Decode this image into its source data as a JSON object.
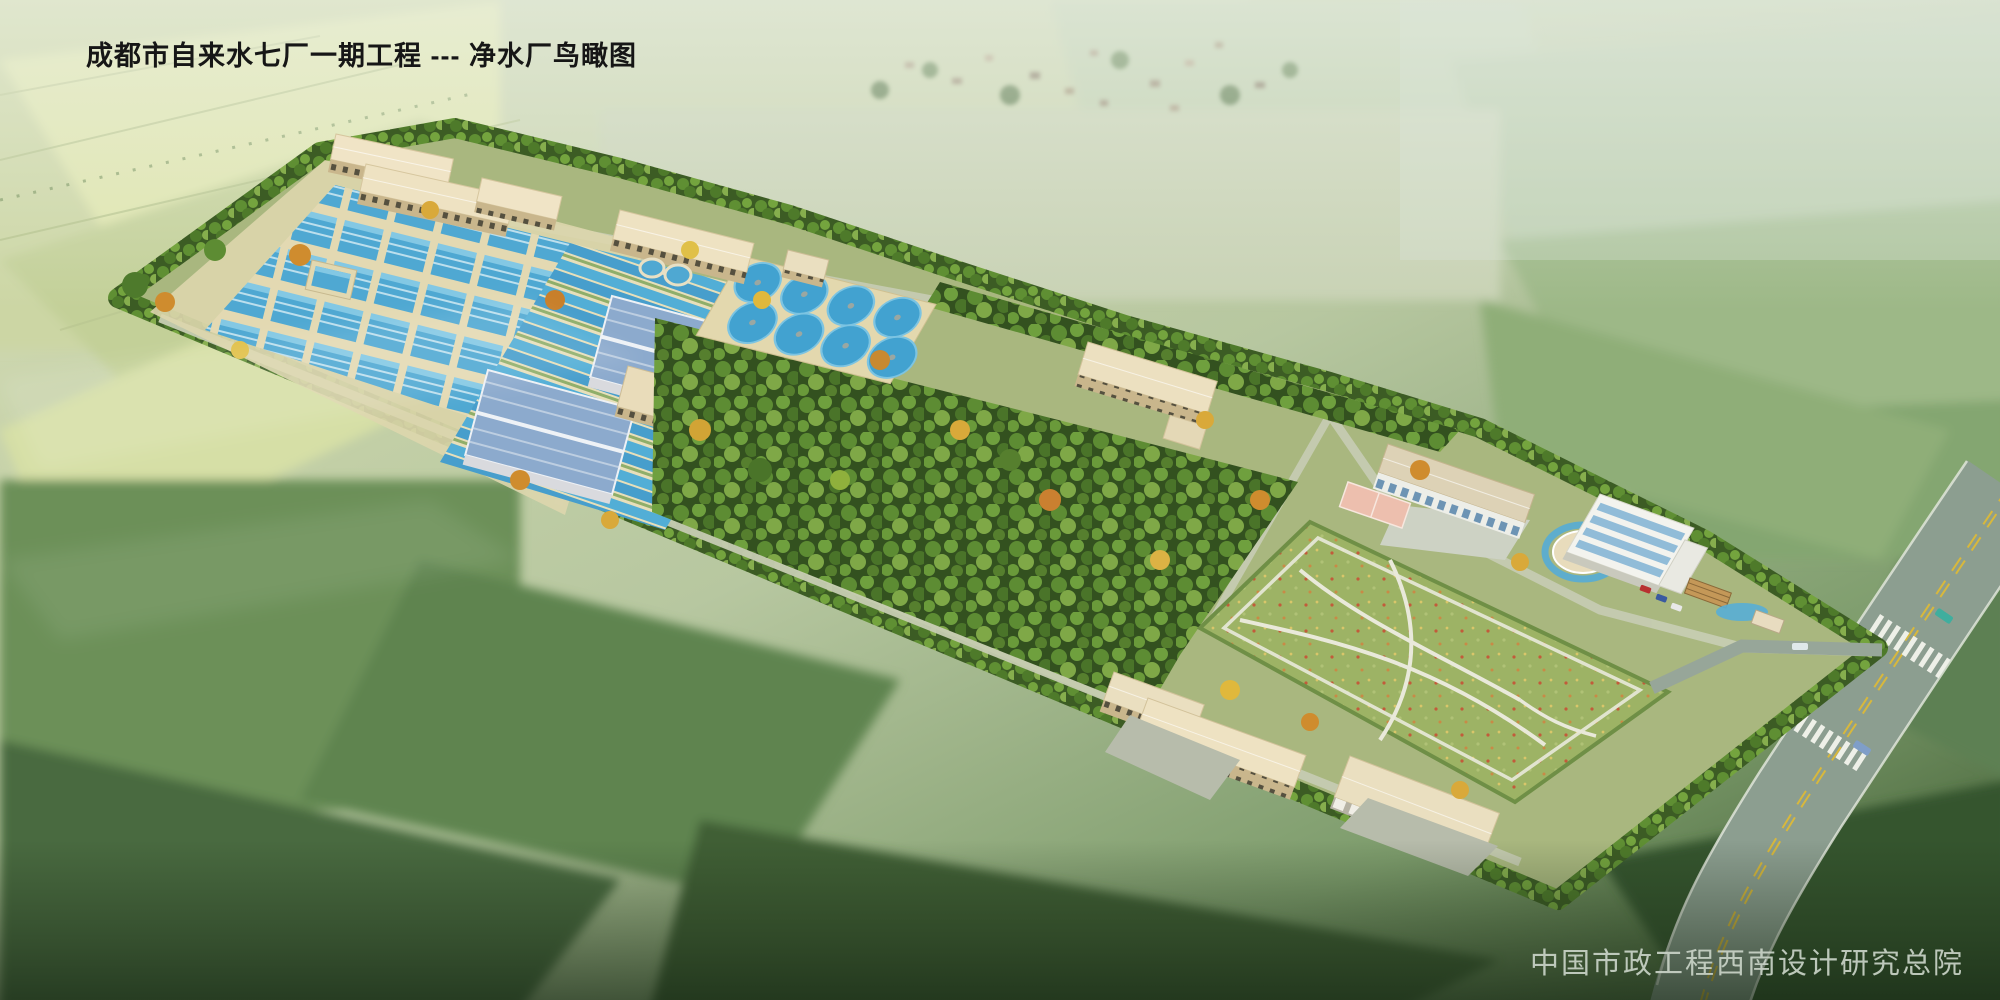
{
  "title": "成都市自来水七厂一期工程 --- 净水厂鸟瞰图",
  "credit": "中国市政工程西南设计研究总院",
  "scene": {
    "description": "aerial rendering of a water treatment plant site surrounded by farmland",
    "clarifier_count": 8,
    "colors": {
      "basin_water": "#4fa8d2",
      "metal_roof_blue": "#8caacd",
      "roof_beige": "#eee2c2",
      "foliage_green": "#4e7a2c",
      "autumn_foliage": "#cf8c2e",
      "lawn_green": "#9db365",
      "road_grey": "#8c9e90",
      "field_light": "#dfe5ad",
      "field_dark": "#4a6a40"
    }
  }
}
